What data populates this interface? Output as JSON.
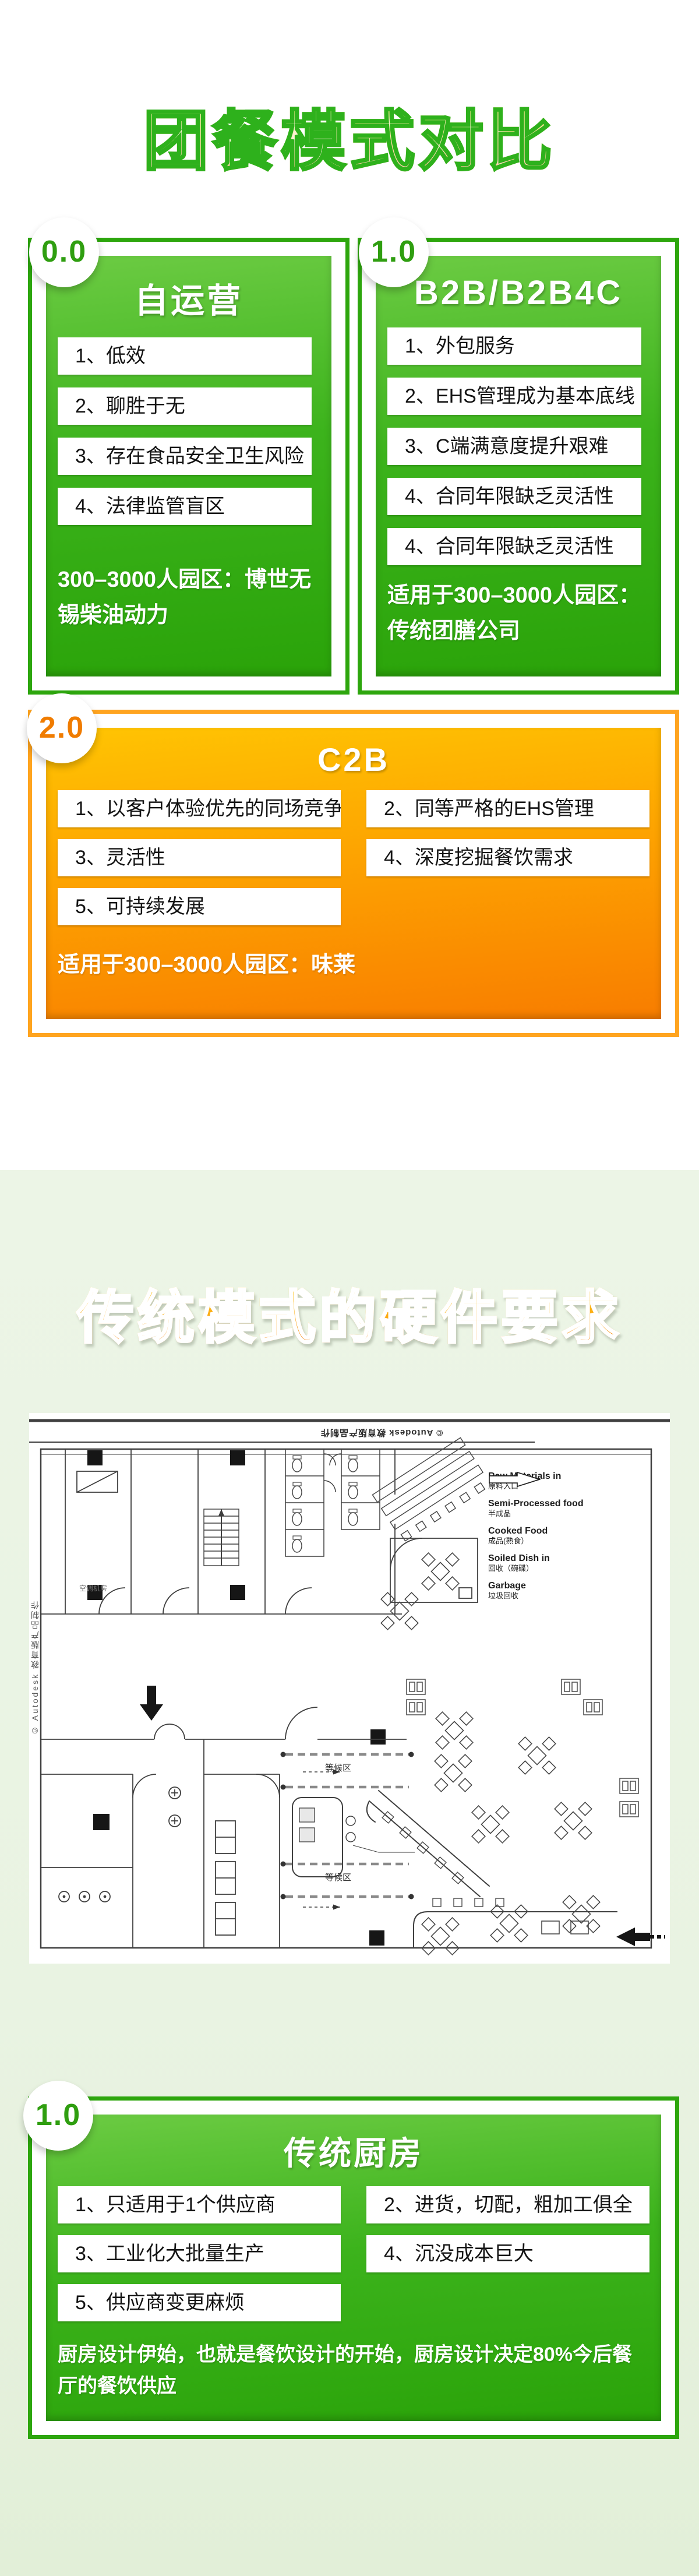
{
  "colors": {
    "green_border": "#2da60d",
    "green_panel_light": "#6ccb43",
    "green_panel_dark": "#2aa309",
    "orange_border": "#ffa41f",
    "orange_panel_light": "#ffc402",
    "orange_panel_dark": "#f87d00",
    "badge_green_text": "#2f9e10",
    "badge_orange_text": "#f07c00",
    "section2_background": "#eaf4e4"
  },
  "section1": {
    "title": "团餐模式对比",
    "cards": [
      {
        "badge": "0.0",
        "name": "自运营",
        "items": [
          "1、低效",
          "2、聊胜于无",
          "3、存在食品安全卫生风险",
          "4、法律监管盲区"
        ],
        "footer": "300–3000人园区：博世无锡柴油动力"
      },
      {
        "badge": "1.0",
        "name": "B2B/B2B4C",
        "items": [
          "1、外包服务",
          "2、EHS管理成为基本底线",
          "3、C端满意度提升艰难",
          "4、合同年限缺乏灵活性",
          "4、合同年限缺乏灵活性"
        ],
        "footer": "适用于300–3000人园区：传统团膳公司"
      },
      {
        "badge": "2.0",
        "name": "C2B",
        "items": [
          "1、以客户体验优先的同场竞争",
          "2、同等严格的EHS管理",
          "3、灵活性",
          "4、深度挖掘餐饮需求",
          "5、可持续发展"
        ],
        "footer": "适用于300–3000人园区：味莱"
      }
    ]
  },
  "section2": {
    "title": "传统模式的硬件要求",
    "blueprint": {
      "watermark_top": "© Autodesk 教育版产品制作",
      "watermark_left": "© Autodesk 教育版产品制作",
      "room_labels": [
        "空调机房",
        "等候区",
        "等候区"
      ],
      "legend": [
        {
          "en": "Raw Materials in",
          "zh": "原料入口"
        },
        {
          "en": "Semi-Processed food",
          "zh": "半成品"
        },
        {
          "en": "Cooked Food",
          "zh": "成品(熟食）"
        },
        {
          "en": "Soiled Dish in",
          "zh": "回收（碗碟）"
        },
        {
          "en": "Garbage",
          "zh": "垃圾回收"
        }
      ]
    },
    "card": {
      "badge": "1.0",
      "name": "传统厨房",
      "items": [
        "1、只适用于1个供应商",
        "2、进货，切配，粗加工俱全",
        "3、工业化大批量生产",
        "4、沉没成本巨大",
        "5、供应商变更麻烦"
      ],
      "footer": "厨房设计伊始，也就是餐饮设计的开始，厨房设计决定80%今后餐厅的餐饮供应"
    }
  }
}
